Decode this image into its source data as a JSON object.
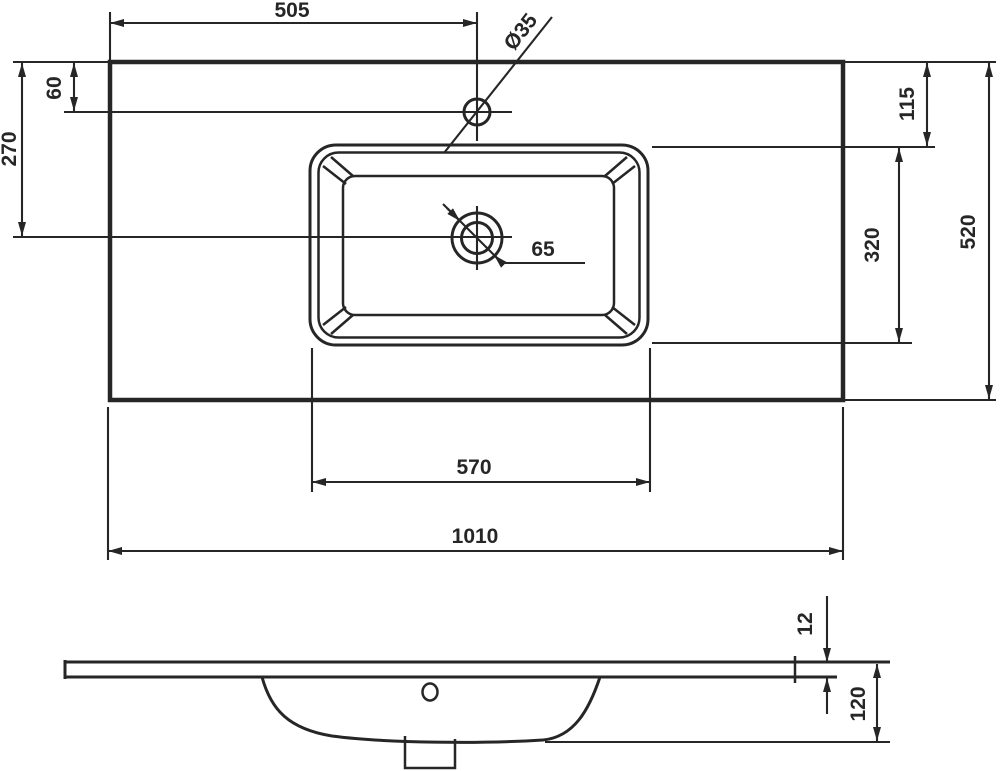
{
  "colors": {
    "line_color": "#262626",
    "background": "#ffffff"
  },
  "top_view": {
    "dimensions": {
      "faucet_offset_from_left": "505",
      "faucet_hole_diameter": "Ø35",
      "faucet_offset_from_back_edge": "60",
      "drain_offset_from_back_edge": "270",
      "basin_offset_from_back_edge": "115",
      "total_depth": "520",
      "basin_opening_depth": "320",
      "drain_diameter": "65",
      "basin_opening_width": "570",
      "total_width": "1010"
    }
  },
  "side_view": {
    "dimensions": {
      "countertop_thickness": "12",
      "total_height": "120"
    }
  }
}
